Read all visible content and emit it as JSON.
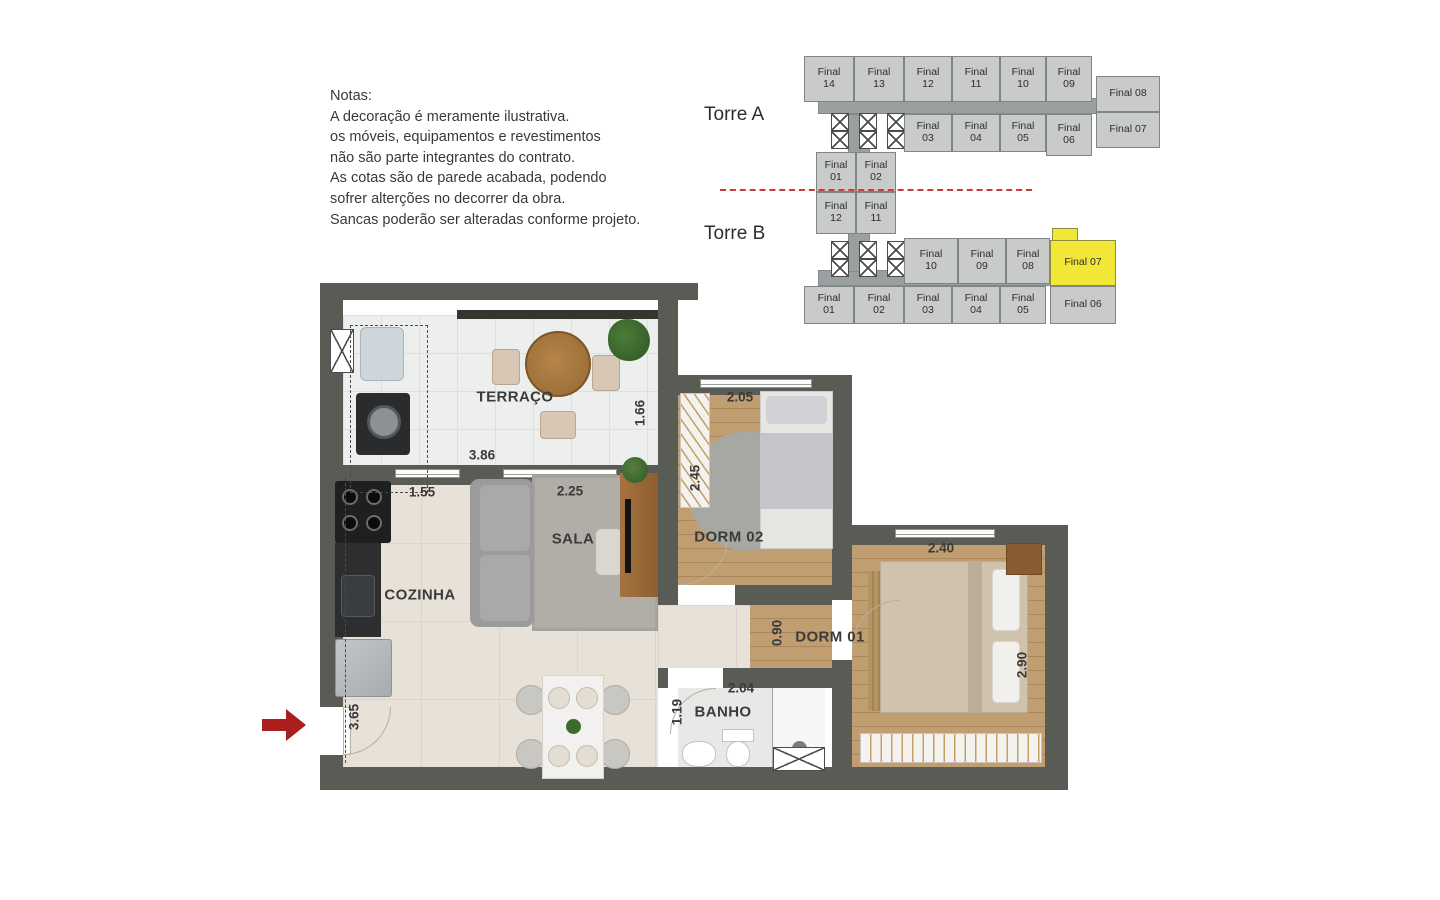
{
  "notes": {
    "title": "Notas:",
    "lines": [
      "A decoração é meramente ilustrativa.",
      "os móveis, equipamentos e revestimentos",
      "não são parte integrantes do contrato.",
      "As cotas são de parede acabada, podendo",
      "sofrer alterções no decorrer da obra.",
      "Sancas poderão ser alteradas conforme projeto."
    ]
  },
  "key_plan": {
    "torre_a_label": "Torre A",
    "torre_b_label": "Torre B",
    "highlight_color": "#f2e636",
    "torre_a": {
      "top_row": [
        "Final 14",
        "Final 13",
        "Final 12",
        "Final 11",
        "Final 10",
        "Final 09"
      ],
      "right_column": [
        "Final 08",
        "Final 07"
      ],
      "bottom_row": [
        "Final 03",
        "Final 04",
        "Final 05",
        "Final 06"
      ],
      "wing": [
        "Final 01",
        "Final 02"
      ]
    },
    "torre_b": {
      "wing": [
        "Final 12",
        "Final 11"
      ],
      "top_row": [
        "Final 10",
        "Final 09",
        "Final 08"
      ],
      "highlighted_unit": "Final 07",
      "right_column_lower": "Final 06",
      "bottom_row": [
        "Final 01",
        "Final 02",
        "Final 03",
        "Final 04",
        "Final 05"
      ]
    }
  },
  "floor_plan": {
    "rooms": {
      "terraco": {
        "label": "TERRAÇO",
        "width_m": "3.86",
        "depth_m": "1.66"
      },
      "cozinha": {
        "label": "COZINHA",
        "width_m": "1.55"
      },
      "sala": {
        "label": "SALA",
        "width_m": "2.25"
      },
      "dorm02": {
        "label": "DORM 02",
        "width_m": "2.05",
        "depth_m": "2.45"
      },
      "dorm01": {
        "label": "DORM 01",
        "width_m": "2.40",
        "depth_m": "2.90"
      },
      "banho": {
        "label": "BANHO",
        "width_m": "2.04",
        "depth_m": "1.19"
      },
      "hall": {
        "width_m": "0.90"
      },
      "entry": {
        "wall_m": "3.65"
      }
    }
  }
}
